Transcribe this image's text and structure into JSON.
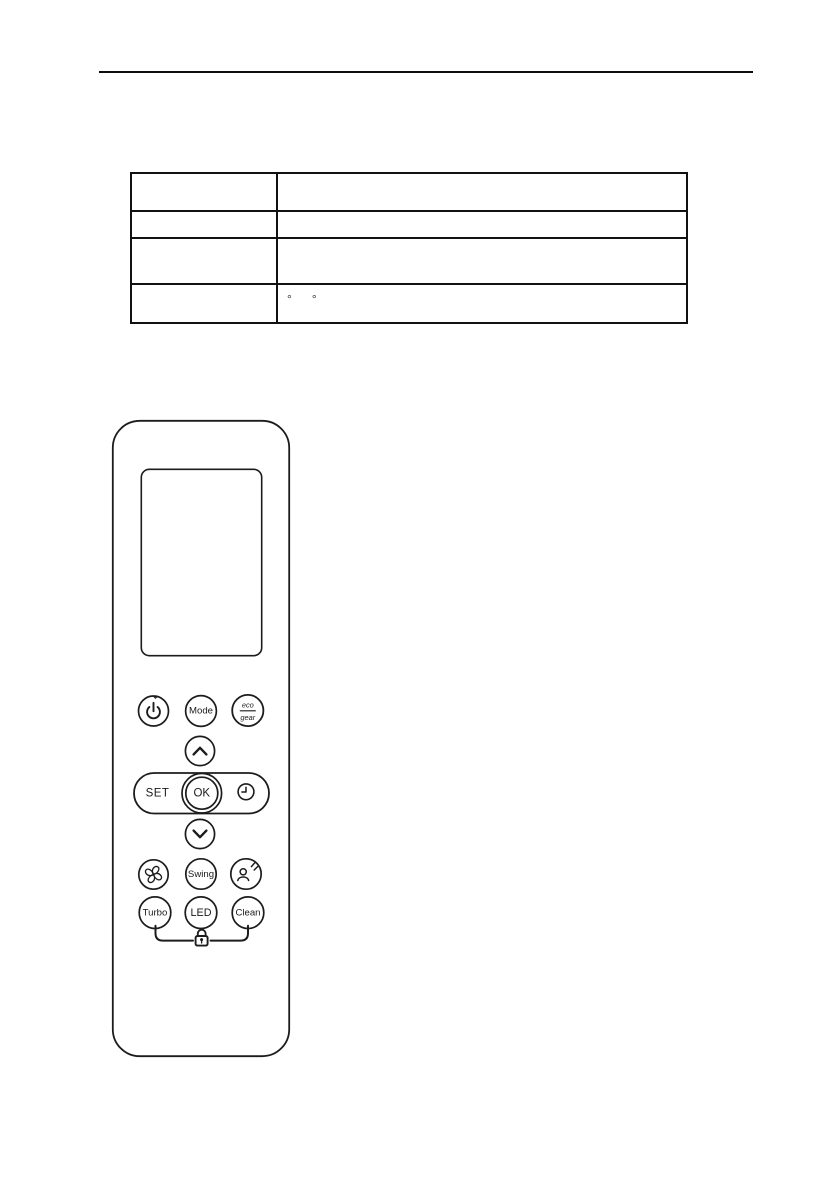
{
  "page": {
    "background": "#ffffff",
    "ink": "#1a1a1a",
    "kind": "manual-page-with-remote-control-figure"
  },
  "header_rule": {
    "present": true,
    "color": "#0d0d0d"
  },
  "spec_table": {
    "columns": 2,
    "rows": [
      {
        "left": "",
        "right": ""
      },
      {
        "left": "",
        "right": ""
      },
      {
        "left": "",
        "right": ""
      },
      {
        "left": "",
        "right": ""
      }
    ],
    "degree_marks": [
      "°",
      "°"
    ]
  },
  "remote_figure": {
    "display": {
      "text": ""
    },
    "labels": {
      "mode": "Mode",
      "eco": "eco",
      "gear": "gear",
      "set": "SET",
      "ok": "OK",
      "swing": "Swing",
      "turbo": "Turbo",
      "led": "LED",
      "clean": "Clean"
    },
    "icons": [
      "power-icon",
      "chevron-up-icon",
      "clock-icon",
      "chevron-down-icon",
      "fan-icon",
      "sleep-icon",
      "lock-icon"
    ]
  }
}
